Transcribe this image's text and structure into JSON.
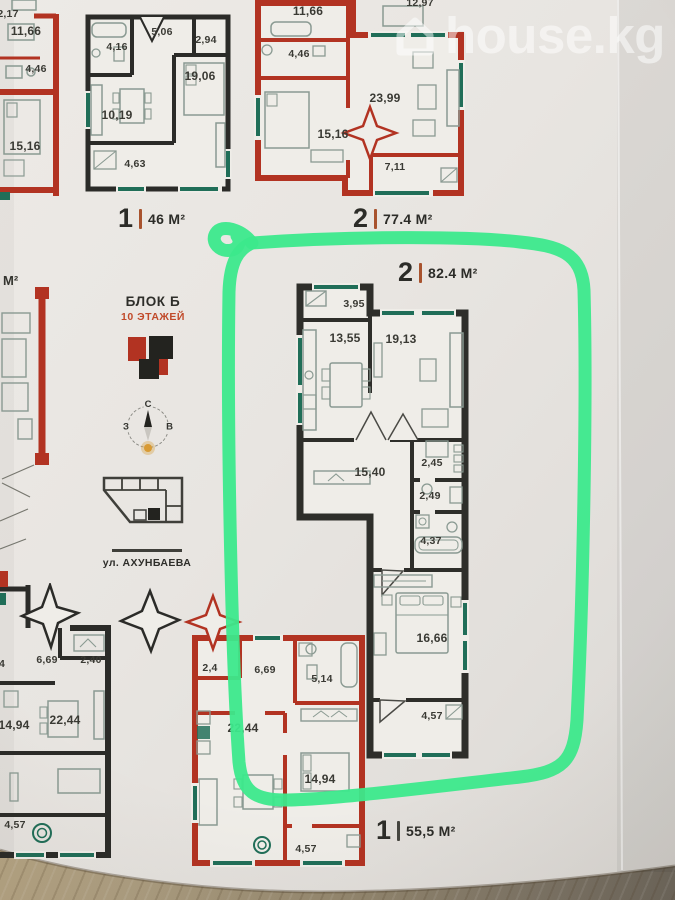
{
  "watermark": {
    "text": "house.kg",
    "icon": "house-icon",
    "color": "#ffffff"
  },
  "area_labels": {
    "plan_46": {
      "num": "1",
      "value": "46 М²"
    },
    "plan_77": {
      "num": "2",
      "value": "77.4 М²"
    },
    "plan_82": {
      "num": "2",
      "value": "82.4 М²"
    },
    "plan_55": {
      "num": "1",
      "value": "55,5 М²"
    }
  },
  "info_panel": {
    "block": "БЛОК Б",
    "floors": "10 ЭТАЖЕЙ",
    "street": "ул. АХУНБАЕВА",
    "m2_fragment": "М²",
    "compass": {
      "north": "С",
      "west": "З",
      "east": "В"
    }
  },
  "plans": {
    "top_left": {
      "rooms": [
        "2,17",
        "11,66",
        "4,46",
        "15,16"
      ]
    },
    "top_middle": {
      "rooms": [
        "4,16",
        "5,06",
        "2,94",
        "19,06",
        "10,19",
        "4,63"
      ]
    },
    "top_right": {
      "rooms": [
        "12,97",
        "11,66",
        "4,46",
        "23,99",
        "15,16",
        "7,11"
      ]
    },
    "circled": {
      "rooms": [
        "3,95",
        "13,55",
        "19,13",
        "15,40",
        "2,45",
        "2,49",
        "4,37",
        "16,66",
        "4,57"
      ]
    },
    "bottom_left": {
      "rooms": [
        "4",
        "6,69",
        "2,40",
        "22,44",
        "14,94",
        "4,57"
      ]
    },
    "bottom_middle": {
      "rooms": [
        "2,4",
        "6,69",
        "5,14",
        "22,44",
        "14,94",
        "4,57"
      ]
    }
  },
  "colors": {
    "marker_green": "#3ce98c",
    "wall_red": "#b23322",
    "wall_dark": "#2b2b28",
    "window_teal": "#206e58",
    "accent_orange": "#c14a2a"
  }
}
